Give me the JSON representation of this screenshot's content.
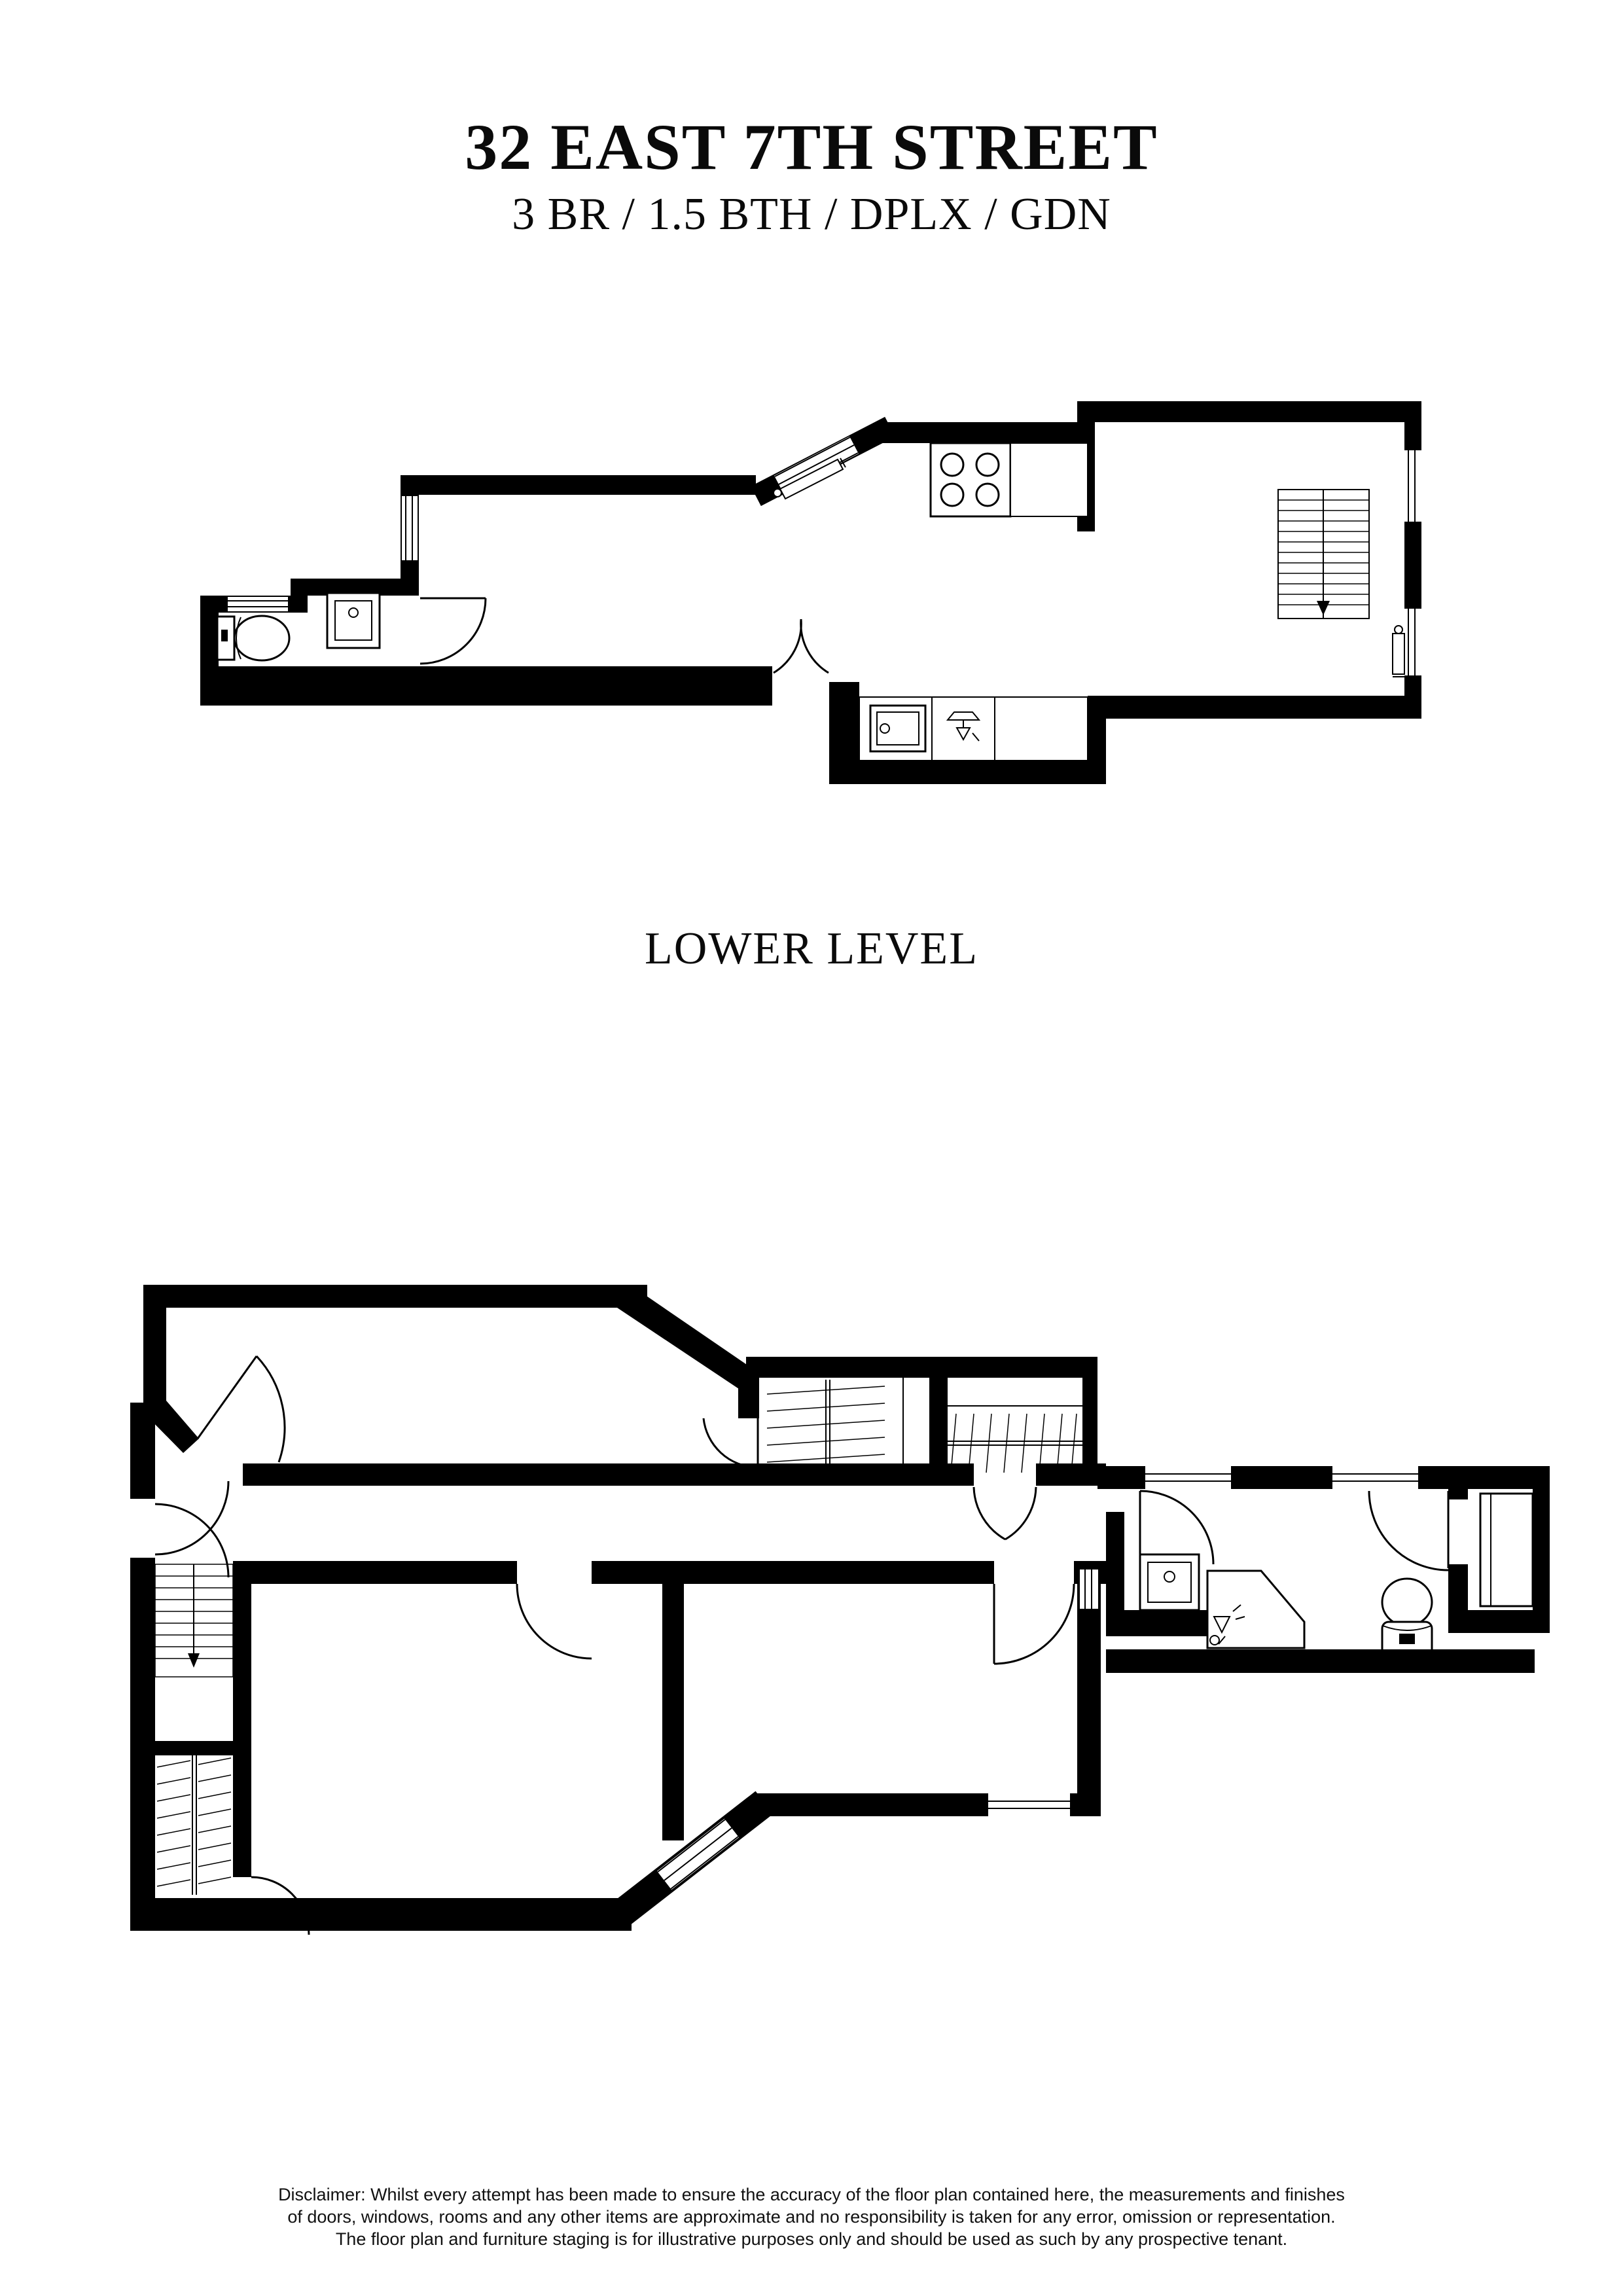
{
  "header": {
    "title": "32 EAST 7TH STREET",
    "subtitle": "3 BR / 1.5 BTH / DPLX / GDN"
  },
  "level_label": "LOWER LEVEL",
  "disclaimer": {
    "line1": "Disclaimer: Whilst every attempt has been made to ensure the accuracy of the floor plan contained here, the measurements and finishes",
    "line2": "of doors, windows, rooms and any other items are approximate and no responsibility is taken for any error, omission or representation.",
    "line3": "The floor plan and furniture staging is for illustrative purposes only and should be used as such by any prospective tenant."
  },
  "colors": {
    "ink": "#000000",
    "paper": "#ffffff"
  },
  "plans": {
    "upper_plan_fixtures": [
      "toilet-icon",
      "sink-icon",
      "stove-icon",
      "kitchen-sink-icon",
      "dishwasher-icon",
      "stairs-down-icon",
      "radiator-icon"
    ],
    "lower_plan_fixtures": [
      "stairs-down-icon",
      "wardrobe-hanging-icon",
      "wardrobe-hanging-icon",
      "under-stair-closet-icon",
      "vanity-sink-icon",
      "corner-shower-icon",
      "toilet-icon",
      "built-in-wardrobe-icon"
    ],
    "door_count": 12,
    "window_count": 10
  }
}
